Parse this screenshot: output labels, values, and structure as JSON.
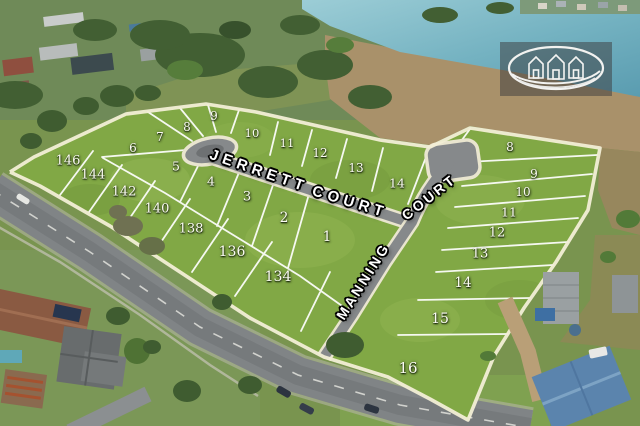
{
  "streets": {
    "jerrett": {
      "word1": "JERRETT",
      "word2": "COURT"
    },
    "manning": {
      "word1": "MANNING",
      "word2": "COURT"
    }
  },
  "lots": [
    {
      "num": "146"
    },
    {
      "num": "144"
    },
    {
      "num": "142"
    },
    {
      "num": "140"
    },
    {
      "num": "138"
    },
    {
      "num": "136"
    },
    {
      "num": "134"
    },
    {
      "num": "6"
    },
    {
      "num": "7"
    },
    {
      "num": "8"
    },
    {
      "num": "9"
    },
    {
      "num": "5"
    },
    {
      "num": "4"
    },
    {
      "num": "3"
    },
    {
      "num": "2"
    },
    {
      "num": "1"
    },
    {
      "num": "10"
    },
    {
      "num": "11"
    },
    {
      "num": "12"
    },
    {
      "num": "13"
    },
    {
      "num": "14"
    },
    {
      "num": "8"
    },
    {
      "num": "9"
    },
    {
      "num": "10"
    },
    {
      "num": "11"
    },
    {
      "num": "12"
    },
    {
      "num": "13"
    },
    {
      "num": "14"
    },
    {
      "num": "15"
    },
    {
      "num": "16"
    }
  ],
  "watermark": {
    "icon": "three-houses-ellipse-logo"
  },
  "colors": {
    "estate_grass": "#81a845",
    "water": "#79b6c4",
    "road": "#808486",
    "boundary_line": "#f2eed6",
    "lot_line": "#ffffff",
    "scrub": "#a9916a"
  }
}
